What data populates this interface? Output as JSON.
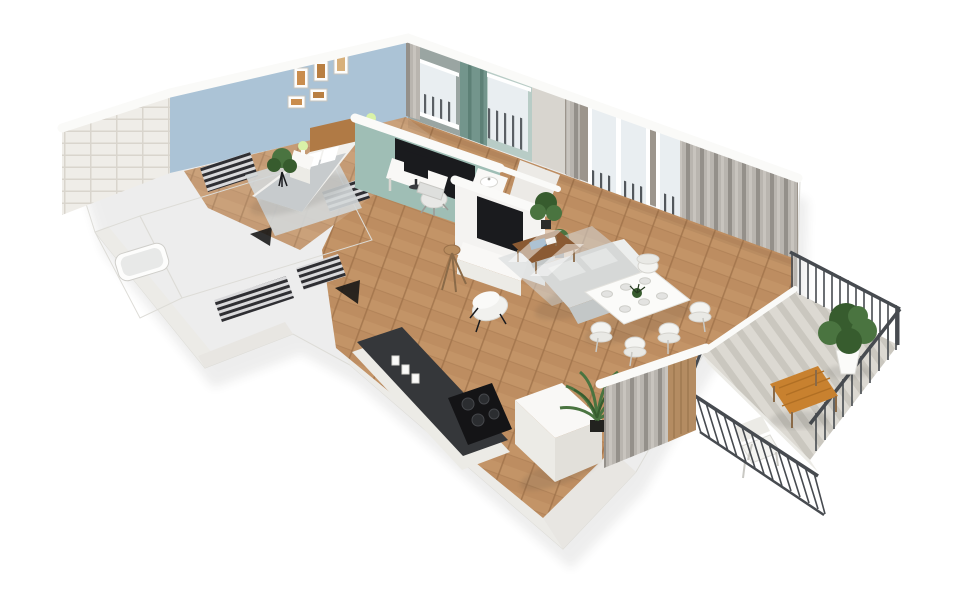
{
  "watermark": {
    "text": "expander",
    "opacity": "0.5",
    "color": "#ffffff",
    "emblem": "expander-flag-emblem"
  },
  "palette": {
    "background": "#ffffff",
    "wall_white": "#f4f3f1",
    "wall_top": "#fafaf8",
    "wall_shade": "#e8e6e2",
    "wall_shade2": "#ecebe7",
    "edge_gray": "#dddcd7",
    "wall_blue": "#abc3d6",
    "wall_teal": "#9fbeb5",
    "wall_taupe": "#9c958c",
    "glass": "#e9eef1",
    "window_bar": "#41464b",
    "curtain_light": "#b9b5af",
    "curtain_mid": "#c8c4be",
    "curtain_dark": "#94908a",
    "curtain_teal": "#73958c",
    "curtain_teal_dark": "#5d8076",
    "brick": "#efede8",
    "brick_line": "#d9d5cd",
    "floor_wood": "#bd8d61",
    "floor_wood_light": "#c99c6e",
    "floor_wood_dark": "#a0734b",
    "tile": "#dcd9d2",
    "tile_stripe": "#c7c4bc",
    "rack_light": "#d9d9db",
    "rack_dark": "#2f2f33",
    "railing": "#474b50",
    "furn_white": "#f9f8f6",
    "furn_cream": "#ecebe6",
    "mattress": "#f2f1ee",
    "sofa": "#d6d8d7",
    "sofa_back": "#c3c7c7",
    "rug": "#d3d7d8",
    "headboard": "#b07a45",
    "coffee_table": "#8a5a33",
    "balcony_table": "#c8812f",
    "counter_dark": "#35373a",
    "screen_black": "#1a1b1e",
    "plant_green": "#4a7440",
    "plant_dark": "#375c2e",
    "lamp_glow": "#d9f2a8",
    "leg_brown": "#8a6a48",
    "watermark_color": "#ffffff"
  },
  "scene": {
    "type": "3d-apartment-floor-plan-render",
    "rooms": [
      {
        "name": "bedroom",
        "wall_color_key": "wall_blue",
        "items": [
          "double-bed",
          "headboard",
          "nightstand",
          "table-lamp",
          "wall-art",
          "potted-plant",
          "rug",
          "wardrobe-rack"
        ]
      },
      {
        "name": "home-office",
        "wall_color_key": "wall_teal",
        "items": [
          "desk",
          "monitor",
          "office-chair",
          "wall-screen"
        ]
      },
      {
        "name": "small-bathroom",
        "items": [
          "washbasin-cabinet",
          "window"
        ]
      },
      {
        "name": "living-room",
        "wall_color_key": "wall_taupe",
        "items": [
          "tv",
          "tv-console",
          "sofa",
          "coffee-table",
          "armchair",
          "tripod-stool",
          "dining-table",
          "dining-chair",
          "plates",
          "curtains",
          "window",
          "potted-plant"
        ]
      },
      {
        "name": "kitchen",
        "items": [
          "counter",
          "cooktop",
          "fridge",
          "palm-plant",
          "jars"
        ]
      },
      {
        "name": "bathroom",
        "items": [
          "bathtub",
          "white-brick-wall"
        ]
      },
      {
        "name": "hallway",
        "items": [
          "clothes-rack",
          "door-opening"
        ]
      },
      {
        "name": "balcony",
        "items": [
          "metal-railing",
          "tiled-floor",
          "potted-bush",
          "wooden-table",
          "chair"
        ]
      }
    ]
  }
}
